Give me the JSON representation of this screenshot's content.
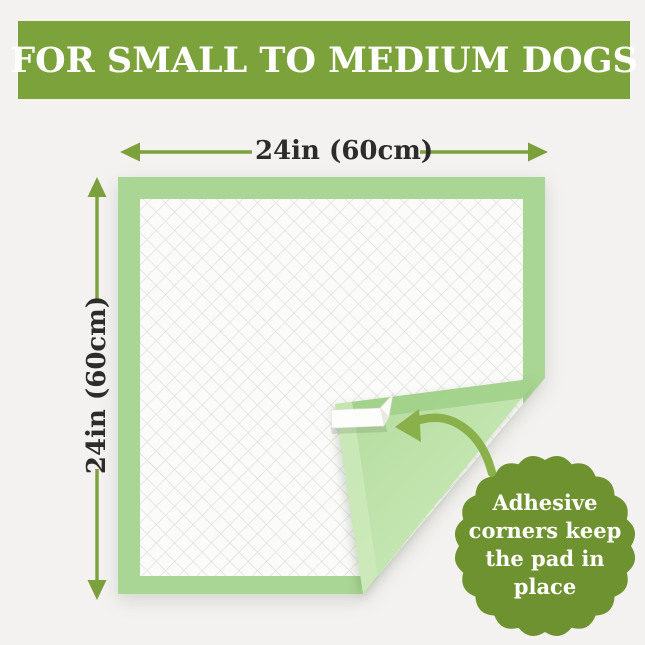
{
  "banner": {
    "title": "FOR SMALL TO MEDIUM DOGS",
    "bg_color": "#7ca23c",
    "text_color": "#ffffff"
  },
  "dimensions": {
    "width_label": "24in (60cm)",
    "height_label": "24in (60cm)",
    "arrow_color": "#7ba03c",
    "label_color": "#2d2c2a"
  },
  "pad": {
    "border_color": "#a9d694",
    "quilt_bg_color": "#fbfbf9",
    "quilt_line_color": "#e4e4df",
    "fold_back_color_light": "#d4eec5",
    "fold_back_color_dark": "#aed897",
    "fold_band_color": "#9bcd83",
    "tape_color": "#fdfdfc"
  },
  "annotation_arrow": {
    "color": "#8ab04c"
  },
  "badge": {
    "lines": [
      "Adhesive",
      "corners keep",
      "the pad in",
      "place"
    ],
    "bg_color": "#6f9231",
    "text_color": "#ffffff"
  },
  "background_color": "#f3f2f0"
}
